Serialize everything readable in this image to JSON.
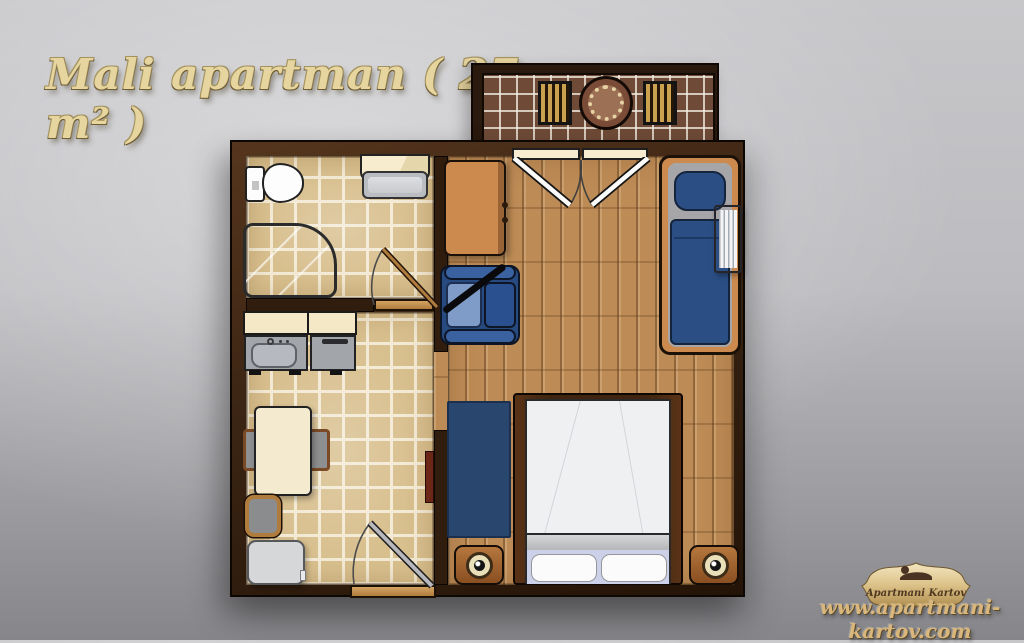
{
  "title": "Mali apartman ( 27 m² )",
  "watermark": {
    "badge_label": "Apartmani Kartov",
    "website": "www.apartmani-kartov.com"
  },
  "colors": {
    "title_gold": "#e7d5a0",
    "logo_gold": "#d8b67c",
    "wall": "#3a2413",
    "tile_floor": "#d8bf8e",
    "grout": "#f3ead5",
    "balcony_tile": "#6f4b37",
    "wood_floor": "#bd8b55",
    "furniture_wood": "#cd8a4f",
    "navy": "#2b4f85",
    "light_blue": "#7f9cc9",
    "cream": "#f5e8c6",
    "fixture_gray": "#ced0d4"
  }
}
